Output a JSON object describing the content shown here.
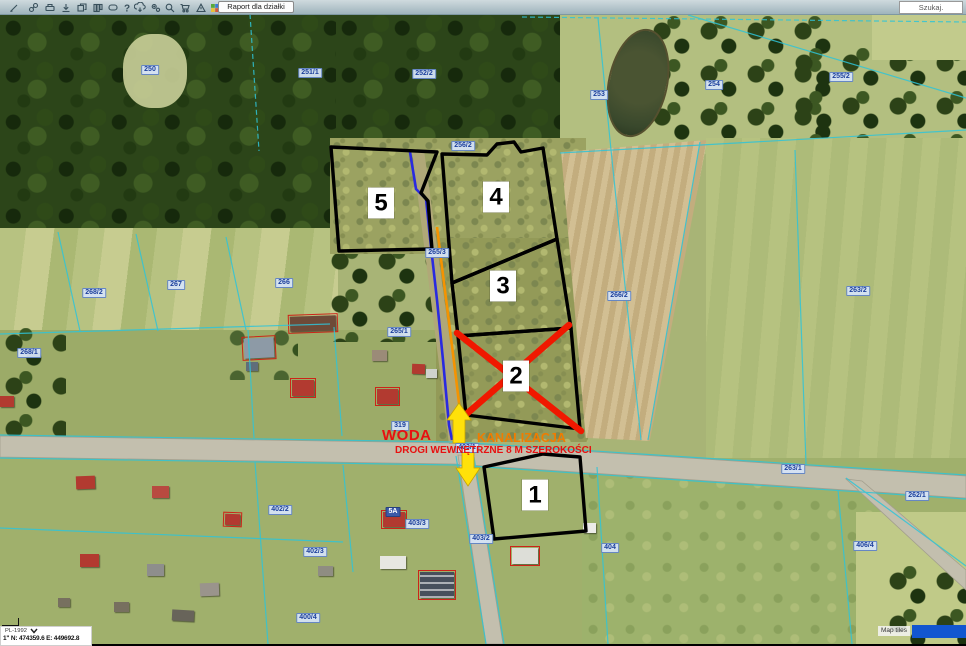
{
  "toolbar": {
    "report_button": "Raport dla działki",
    "search_label": "Szukaj.",
    "icons": [
      {
        "name": "edit-icon"
      },
      {
        "name": "link-icon"
      },
      {
        "name": "print-icon"
      },
      {
        "name": "download-icon"
      },
      {
        "name": "copy-icon"
      },
      {
        "name": "layout-columns-icon"
      },
      {
        "name": "comment-icon"
      },
      {
        "name": "help-icon"
      },
      {
        "name": "cloud-download-icon"
      },
      {
        "name": "settings-gears-icon"
      },
      {
        "name": "search-zoom-icon"
      },
      {
        "name": "cart-icon"
      },
      {
        "name": "warning-icon"
      },
      {
        "name": "layers-colors-icon"
      }
    ]
  },
  "map": {
    "plot_badges": [
      {
        "label": "5",
        "x": 381,
        "y": 203
      },
      {
        "label": "4",
        "x": 496,
        "y": 197
      },
      {
        "label": "3",
        "x": 503,
        "y": 286
      },
      {
        "label": "2",
        "x": 516,
        "y": 376
      },
      {
        "label": "1",
        "x": 535,
        "y": 495
      }
    ],
    "crossed_plot_number": "2",
    "parcel_labels": [
      {
        "text": "250",
        "x": 150,
        "y": 70
      },
      {
        "text": "251/1",
        "x": 310,
        "y": 73
      },
      {
        "text": "252/2",
        "x": 424,
        "y": 74
      },
      {
        "text": "253",
        "x": 599,
        "y": 95
      },
      {
        "text": "254",
        "x": 714,
        "y": 85
      },
      {
        "text": "255/2",
        "x": 841,
        "y": 77
      },
      {
        "text": "256/2",
        "x": 463,
        "y": 146
      },
      {
        "text": "268/2",
        "x": 94,
        "y": 293
      },
      {
        "text": "267",
        "x": 176,
        "y": 285
      },
      {
        "text": "266",
        "x": 284,
        "y": 283
      },
      {
        "text": "268/1",
        "x": 29,
        "y": 353
      },
      {
        "text": "265/1",
        "x": 399,
        "y": 332
      },
      {
        "text": "265/3",
        "x": 437,
        "y": 253
      },
      {
        "text": "266/2",
        "x": 619,
        "y": 296
      },
      {
        "text": "263/2",
        "x": 858,
        "y": 291
      },
      {
        "text": "319",
        "x": 400,
        "y": 426
      },
      {
        "text": "403/1",
        "x": 467,
        "y": 448
      },
      {
        "text": "263/1",
        "x": 793,
        "y": 469
      },
      {
        "text": "262/1",
        "x": 917,
        "y": 496
      },
      {
        "text": "402/2",
        "x": 280,
        "y": 510
      },
      {
        "text": "403/3",
        "x": 417,
        "y": 524
      },
      {
        "text": "403/2",
        "x": 481,
        "y": 539
      },
      {
        "text": "402/3",
        "x": 315,
        "y": 552
      },
      {
        "text": "404",
        "x": 610,
        "y": 548
      },
      {
        "text": "406/4",
        "x": 865,
        "y": 546
      },
      {
        "text": "400/4",
        "x": 308,
        "y": 618
      }
    ],
    "building_labels": [
      {
        "text": "5A",
        "x": 393,
        "y": 512
      }
    ],
    "annotations": {
      "water": "WODA",
      "sewage": "KANALIZACJA",
      "roads": "DROGI WEWNĘTRZNE 8 M SZEROKOŚCI"
    }
  },
  "statusbar": {
    "crs": "PL-1992",
    "coords": "1\"  N: 474359.6   E: 449692.8"
  },
  "attribution": {
    "text": "Map tiles"
  },
  "colors": {
    "plot_outline": "#000000",
    "cross": "#f01800",
    "water_line": "#2a2ae0",
    "sewage_line": "#f59300",
    "arrow": "#ffe10a",
    "cadastral_line": "#2fc4d8",
    "annotation_red": "#e81010",
    "annotation_orange": "#f07c00"
  }
}
